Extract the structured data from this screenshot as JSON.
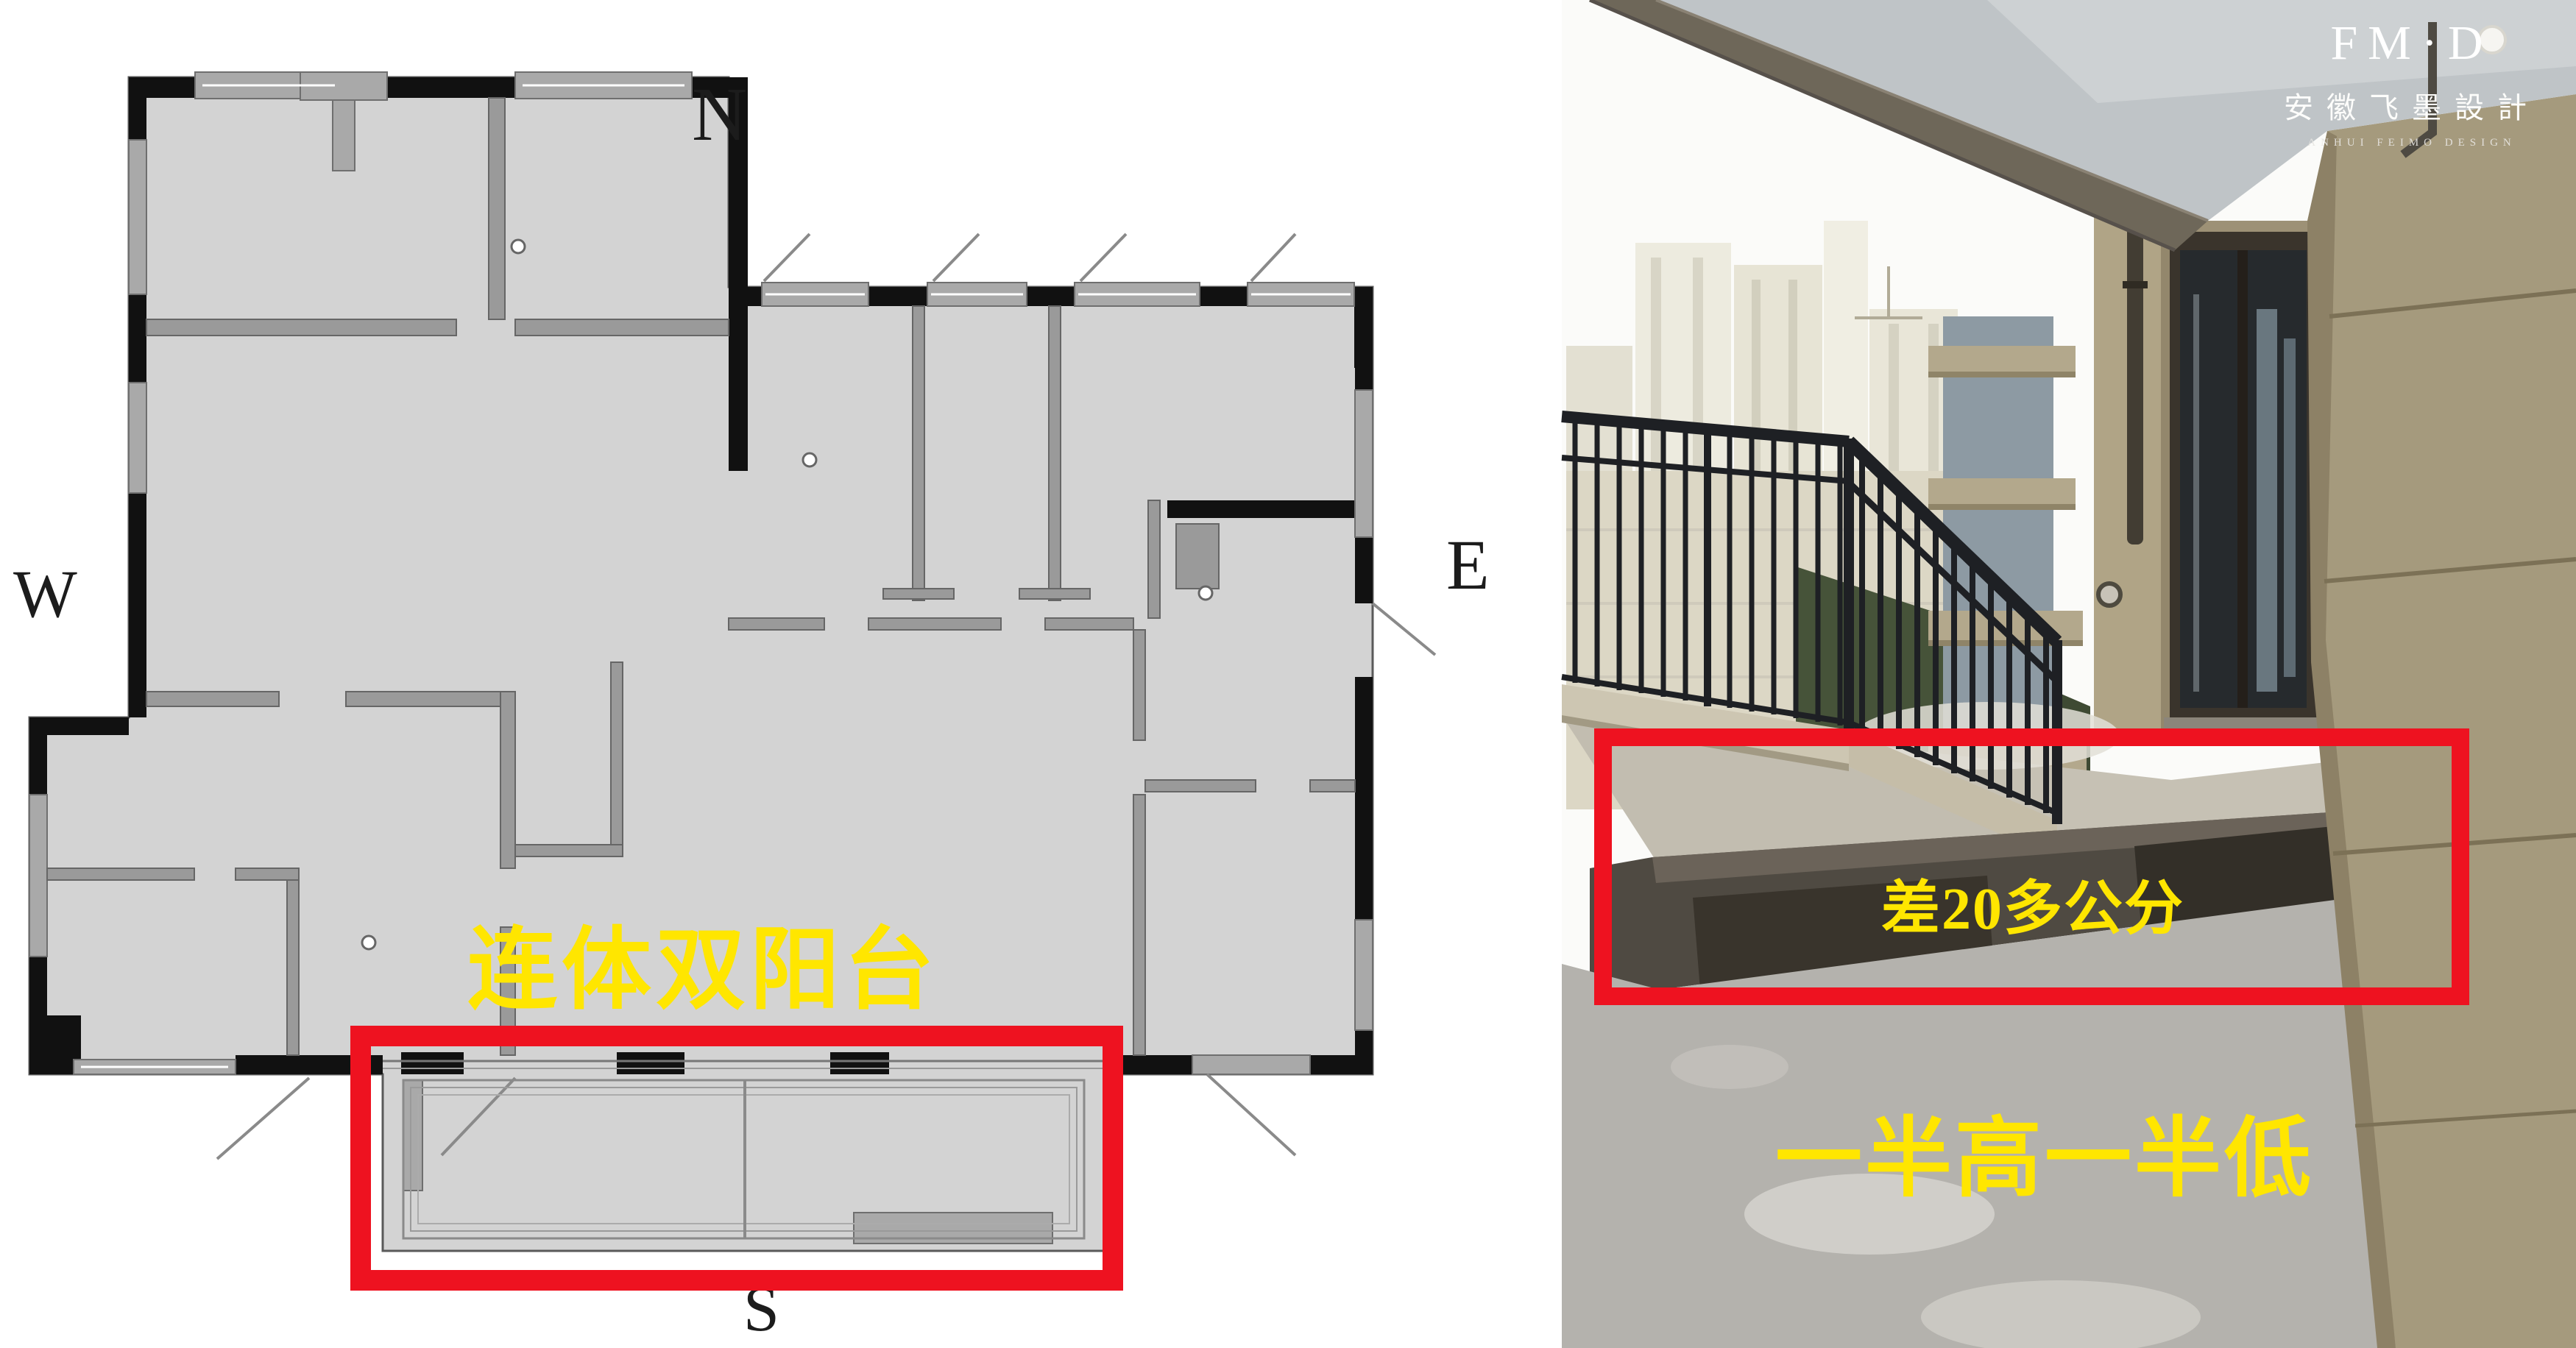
{
  "floor_plan": {
    "compass": {
      "north": "N",
      "south": "S",
      "east": "E",
      "west": "W"
    },
    "caption": {
      "text": "连体双阳台",
      "color": "#ffe600"
    },
    "highlight_box_color": "#ee1220"
  },
  "photo": {
    "step_annotation": {
      "text": "差20多公分",
      "color": "#ffe600"
    },
    "caption": {
      "text": "一半高一半低",
      "color": "#ffe600"
    },
    "highlight_box_color": "#ee1220",
    "watermark": {
      "monogram": "FM·D",
      "company_cn": "安徽飞墨設計",
      "company_en": "ANHUI FEIMO DESIGN"
    }
  }
}
